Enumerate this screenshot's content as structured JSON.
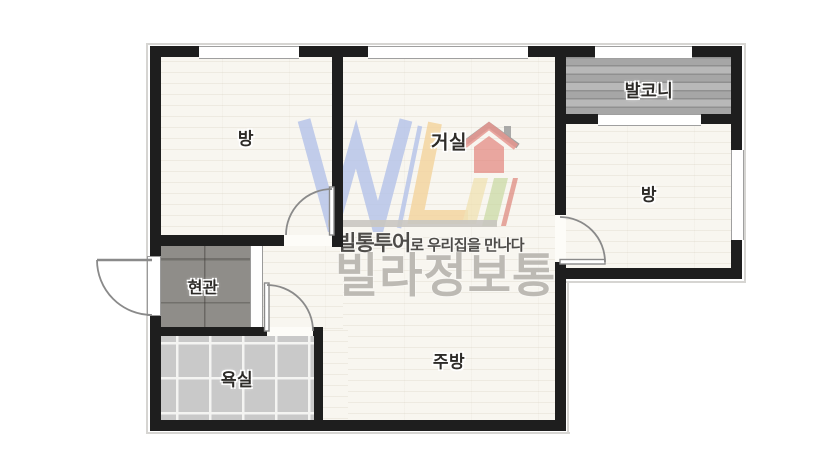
{
  "plan": {
    "rooms": [
      {
        "id": "bedroom-left",
        "label": "방"
      },
      {
        "id": "living-room",
        "label": "거실"
      },
      {
        "id": "balcony",
        "label": "발코니"
      },
      {
        "id": "bedroom-right",
        "label": "방"
      },
      {
        "id": "entrance",
        "label": "현관"
      },
      {
        "id": "bathroom",
        "label": "욕실"
      },
      {
        "id": "kitchen",
        "label": "주방"
      }
    ],
    "watermark": {
      "tagline_bold": "빌통투어",
      "tagline_rest": "로 우리집을 만나다",
      "brand": "빌라정보통"
    },
    "colors": {
      "wall": "#1e1e1e",
      "wood_floor": "#f8f6f0",
      "balcony_floor": "#adadad",
      "bath_tile": "#c9c9c9",
      "entry_tile": "#8f8d89",
      "logo_blue": "#b5c3e9",
      "logo_yellow": "#f4d49e",
      "logo_green": "#c6d89c",
      "logo_red": "#e2837b",
      "brand_text": "#bdbab4",
      "tagline_text": "#4e4c49"
    }
  }
}
